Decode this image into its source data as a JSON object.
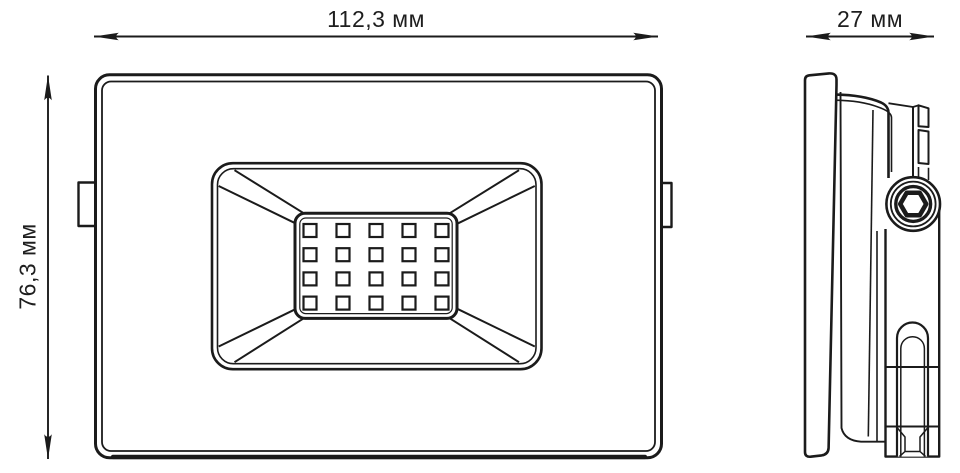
{
  "document": {
    "type": "product dimension drawing",
    "subject": "LED floodlight technical drawing, front view and side view",
    "background_color": "#ffffff",
    "line_color": "#1b1b1b"
  },
  "dimensions": {
    "width": {
      "label": "112,3 мм",
      "view": "front",
      "orientation": "horizontal"
    },
    "height": {
      "label": "76,3 мм",
      "view": "front",
      "orientation": "vertical"
    },
    "depth": {
      "label": "27 мм",
      "view": "side",
      "orientation": "horizontal"
    }
  },
  "front_view": {
    "led_grid": {
      "rows": 4,
      "columns": 5,
      "led_count": 20
    }
  },
  "side_view": {
    "fastener_icon": "hex-socket-bolt"
  }
}
